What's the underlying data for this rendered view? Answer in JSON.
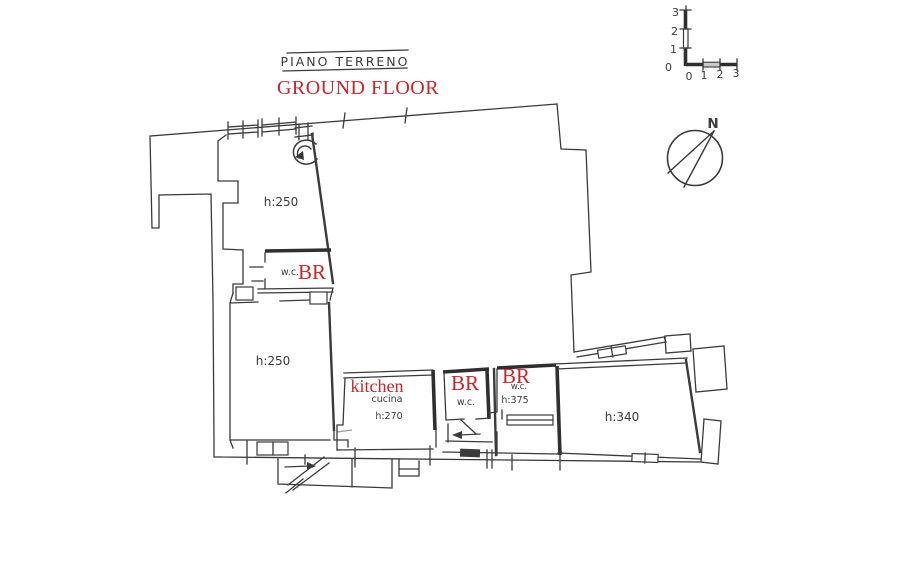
{
  "colors": {
    "background": "#ffffff",
    "ink": "#3a3a3a",
    "annotation_red": "#c9252b"
  },
  "title": {
    "primary": "PIANO TERRENO",
    "secondary": "GROUND FLOOR"
  },
  "scale_bar": {
    "vertical_ticks_top_to_bottom": [
      "3",
      "2",
      "1",
      "0"
    ],
    "horizontal_ticks_left_to_right": [
      "0",
      "1",
      "2",
      "3"
    ]
  },
  "compass": {
    "north_label": "N"
  },
  "rooms": {
    "upper_left": {
      "height_label": "h:250"
    },
    "upper_wc": {
      "label": "w.c."
    },
    "lower_left": {
      "height_label": "h:250"
    },
    "kitchen": {
      "label": "cucina",
      "height_label": "h:270"
    },
    "middle_wc": {
      "label": "w.c."
    },
    "right_wc": {
      "label": "w.c.",
      "height_label": "h:375"
    },
    "right_room": {
      "height_label": "h:340"
    }
  },
  "annotations": {
    "upper_bathroom": "BR",
    "middle_bathroom": "BR",
    "right_bathroom": "BR",
    "kitchen": "kitchen"
  }
}
